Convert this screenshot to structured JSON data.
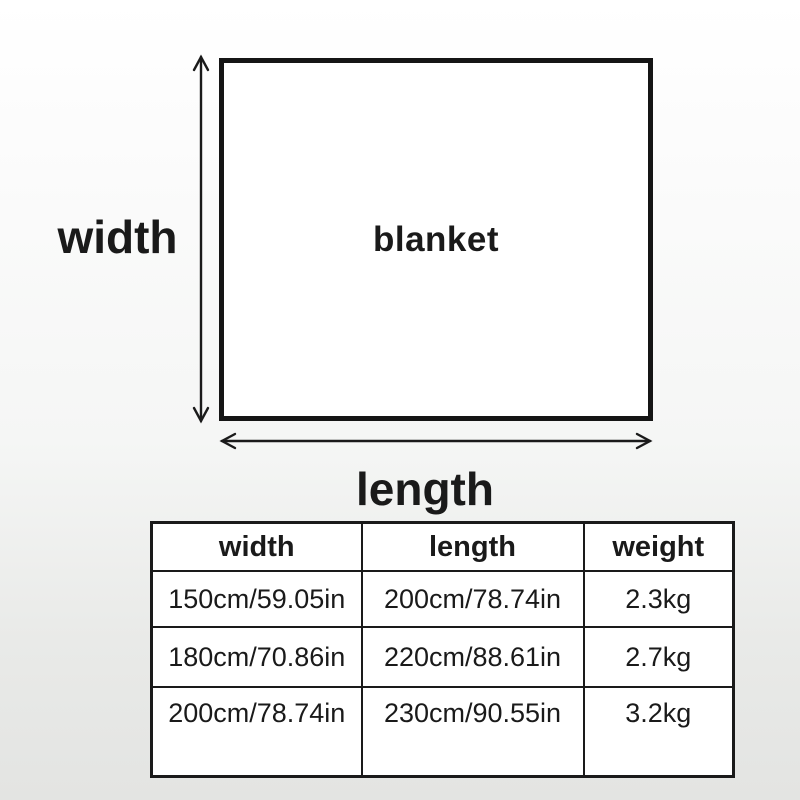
{
  "diagram": {
    "shape_label": "blanket",
    "width_label": "width",
    "length_label": "length"
  },
  "table": {
    "headers": [
      "width",
      "length",
      "weight"
    ],
    "rows": [
      [
        "150cm/59.05in",
        "200cm/78.74in",
        "2.3kg"
      ],
      [
        "180cm/70.86in",
        "220cm/88.61in",
        "2.7kg"
      ],
      [
        "200cm/78.74in",
        "230cm/90.55in",
        "3.2kg"
      ]
    ]
  },
  "colors": {
    "ink": "#1a1a1a",
    "rect_border": "#151515",
    "surface": "#ffffff",
    "background_top": "#ffffff",
    "background_bottom": "#e3e4e2"
  }
}
